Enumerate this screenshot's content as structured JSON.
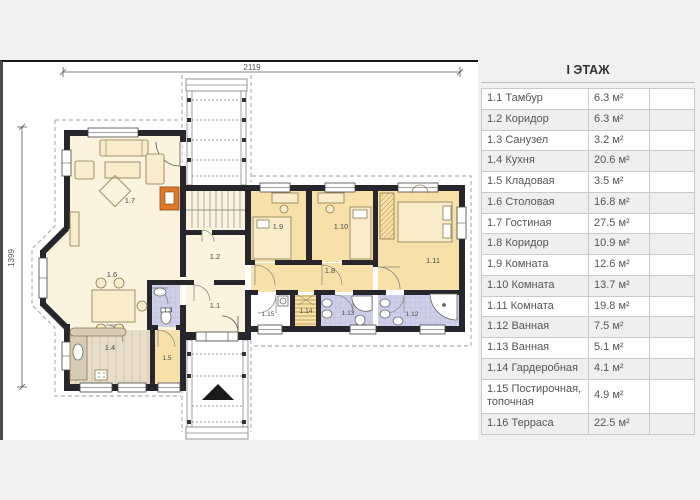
{
  "legend": {
    "header": "I ЭТАЖ",
    "rows": [
      {
        "name": "1.1 Тамбур",
        "area": "6.3 м²"
      },
      {
        "name": "1.2 Коридор",
        "area": "6.3 м²"
      },
      {
        "name": "1.3 Санузел",
        "area": "3.2 м²"
      },
      {
        "name": "1.4 Кухня",
        "area": "20.6 м²"
      },
      {
        "name": "1.5 Кладовая",
        "area": "3.5 м²"
      },
      {
        "name": "1.6 Столовая",
        "area": "16.8 м²"
      },
      {
        "name": "1.7 Гостиная",
        "area": "27.5 м²"
      },
      {
        "name": "1.8 Коридор",
        "area": "10.9 м²"
      },
      {
        "name": "1.9 Комната",
        "area": "12.6 м²"
      },
      {
        "name": "1.10 Комната",
        "area": "13.7 м²"
      },
      {
        "name": "1.11 Комната",
        "area": "19.8 м²"
      },
      {
        "name": "1.12 Ванная",
        "area": "7.5 м²"
      },
      {
        "name": "1.13 Ванная",
        "area": "5.1 м²"
      },
      {
        "name": "1.14 Гардеробная",
        "area": "4.1 м²"
      },
      {
        "name": "1.15 Постирочная, топочная",
        "area": "4.9 м²"
      },
      {
        "name": "1.16 Терраса",
        "area": "22.5 м²"
      }
    ]
  },
  "plan": {
    "dim_top": "2119",
    "dim_left": "1399",
    "room_labels": [
      {
        "text": "1.1"
      },
      {
        "text": "1.2"
      },
      {
        "text": "1.3"
      },
      {
        "text": "1.4"
      },
      {
        "text": "1.5"
      },
      {
        "text": "1.6"
      },
      {
        "text": "1.7"
      },
      {
        "text": "1.8"
      },
      {
        "text": "1.9"
      },
      {
        "text": "1.10"
      },
      {
        "text": "1.11"
      },
      {
        "text": "1.12"
      },
      {
        "text": "1.13"
      },
      {
        "text": "1.14"
      },
      {
        "text": "1.15"
      }
    ]
  },
  "colors": {
    "background": "#f0f0f0",
    "canvas": "#ffffff",
    "wall": "#26262c",
    "room_cream": "#fbf3dd",
    "room_tan": "#f7e1a8",
    "room_tile": "#cfcfe9",
    "kitchen_floor": "#e7ddca",
    "fireplace": "#e0782a",
    "legend_alt_row": "#efefef"
  }
}
